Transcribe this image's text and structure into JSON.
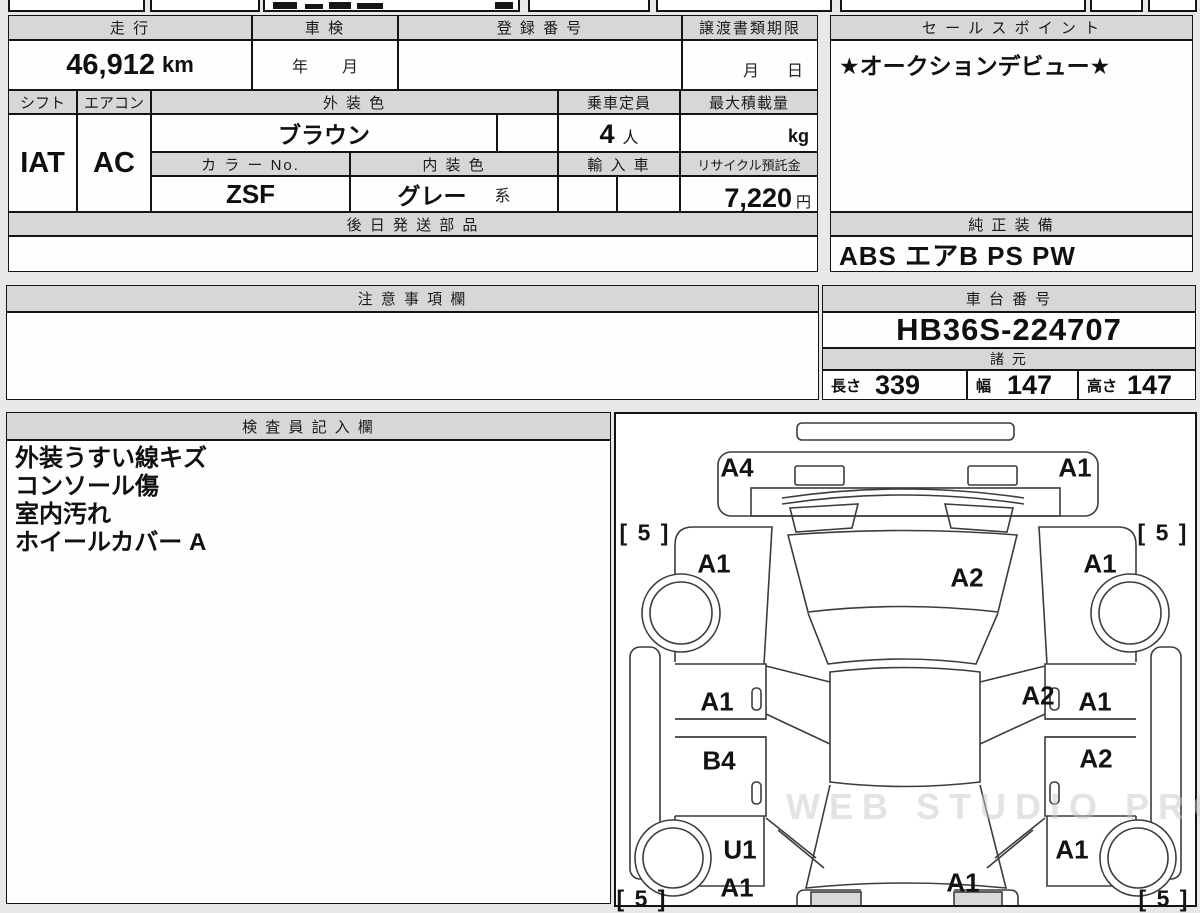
{
  "sheet": {
    "row1": {
      "mileage_label": "走 行",
      "mileage_value": "46,912",
      "mileage_unit": "km",
      "shaken_label": "車 検",
      "shaken_year": "年",
      "shaken_month": "月",
      "reg_label": "登 録 番 号",
      "reg_value": "",
      "transfer_label": "譲渡書類期限",
      "transfer_month": "月",
      "transfer_day": "日"
    },
    "row2": {
      "shift_label": "シフト",
      "shift_value": "IAT",
      "aircon_label": "エアコン",
      "aircon_value": "AC",
      "ext_color_label": "外 装 色",
      "ext_color_value": "ブラウン",
      "capacity_label": "乗車定員",
      "capacity_value": "4",
      "capacity_unit": "人",
      "max_load_label": "最大積載量",
      "max_load_value": "",
      "max_load_unit": "kg"
    },
    "row3": {
      "color_no_label": "カ ラ ー No.",
      "color_no_value": "ZSF",
      "int_color_label": "内 装 色",
      "int_color_value": "グレー",
      "int_color_suffix": "系",
      "import_label": "輸 入 車",
      "import_value": "",
      "recycle_label": "リサイクル預託金",
      "recycle_value": "7,220",
      "recycle_unit": "円"
    },
    "later_parts_label": "後 日 発 送 部 品",
    "later_parts_value": "",
    "sales_point_label": "セ ー ル ス ポ イ ン ト",
    "sales_point_value": "★オークションデビュー★",
    "equipment_label": "純 正 装 備",
    "equipment_value": "ABS エアB PS PW",
    "caution_label": "注 意 事 項 欄",
    "caution_value": "",
    "chassis_label": "車 台 番 号",
    "chassis_value": "HB36S-224707",
    "specs_label": "諸 元",
    "length_label": "長さ",
    "length_value": "339",
    "width_label": "幅",
    "width_value": "147",
    "height_label": "高さ",
    "height_value": "147",
    "inspector_label": "検 査 員 記 入 欄",
    "inspector_lines": [
      "外装うすい線キズ",
      "コンソール傷",
      "室内汚れ",
      "ホイールカバー A"
    ]
  },
  "diagram": {
    "watermark": "WEB STUDIO PRO",
    "labels": [
      {
        "text": "A4"
      },
      {
        "text": "A1"
      },
      {
        "text": "[ 5 ]"
      },
      {
        "text": "[ 5 ]"
      },
      {
        "text": "A1"
      },
      {
        "text": "A1"
      },
      {
        "text": "A2"
      },
      {
        "text": "A2"
      },
      {
        "text": "A1"
      },
      {
        "text": "A1"
      },
      {
        "text": "B4"
      },
      {
        "text": "A2"
      },
      {
        "text": "U1"
      },
      {
        "text": "A1"
      },
      {
        "text": "A1"
      },
      {
        "text": "A1"
      },
      {
        "text": "[ 5 ]"
      },
      {
        "text": "[ 5 ]"
      }
    ]
  }
}
